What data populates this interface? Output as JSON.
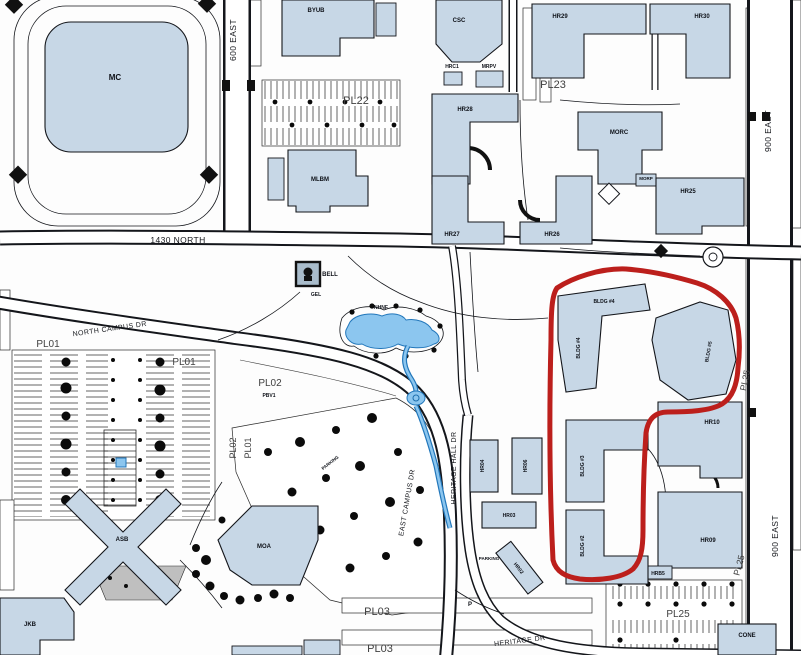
{
  "map": {
    "title": "campus-map",
    "streets": {
      "east600": "600 EAST",
      "east900_top": "900 EAST",
      "east900_bottom": "900 EAST",
      "north1430": "1430 NORTH",
      "north_campus_dr": "NORTH CAMPUS DR",
      "east_campus_dr": "EAST CAMPUS DR",
      "heritage_hall_dr": "HERITAGE HALL DR",
      "heritage_dr": "HERITAGE DR"
    },
    "buildings": {
      "mc": "MC",
      "byub": "BYUB",
      "mlbm": "MLBM",
      "csc": "CSC",
      "hrc1": "HRC1",
      "mrpv": "MRPV",
      "hr25": "HR25",
      "hr26": "HR26",
      "hr27": "HR27",
      "hr28": "HR28",
      "hr29": "HR29",
      "hr30": "HR30",
      "morc": "MORC",
      "morp": "MORP",
      "bell": "BELL",
      "gel": "GEL",
      "nhnf": "NHNF",
      "asb": "ASB",
      "moa": "MOA",
      "jkb": "JKB",
      "cone": "CONE",
      "hr02": "HR02",
      "hr03": "HR03",
      "hr04": "HR04",
      "hr06": "HR06",
      "hr09": "HR09",
      "hr10": "HR10",
      "hrb5": "HRB5",
      "bldg4_top": "BLDG #4",
      "bldg4_side": "BLDG #4",
      "bldg5": "BLDG #5",
      "bldg3": "BLDG #3",
      "bldg2": "BLDG #2"
    },
    "parking": {
      "pl01_a": "PL01",
      "pl01_b": "PL01",
      "pl01_v": "PL01",
      "pl02_v": "PL02",
      "pl02": "PL02",
      "pbv1": "PBV1",
      "pl03_a": "PL03",
      "pl03_b": "PL03",
      "pl22": "PL22",
      "pl23": "PL23",
      "pl25_v1": "PL25",
      "pl25_v2": "PL25",
      "pl25_h": "PL25",
      "parking_a": "PARKING",
      "parking_b": "PARKING",
      "p": "P"
    },
    "annotation": {
      "shape": "freehand-loop"
    },
    "colors": {
      "building_fill": "#c7d7e6",
      "building_stroke": "#14161b",
      "water_fill": "#8cc6ef",
      "water_stroke": "#2277bb",
      "line": "#14161b",
      "annotation": "#bc1f1c",
      "parking_label": "#3f3f3f"
    }
  }
}
